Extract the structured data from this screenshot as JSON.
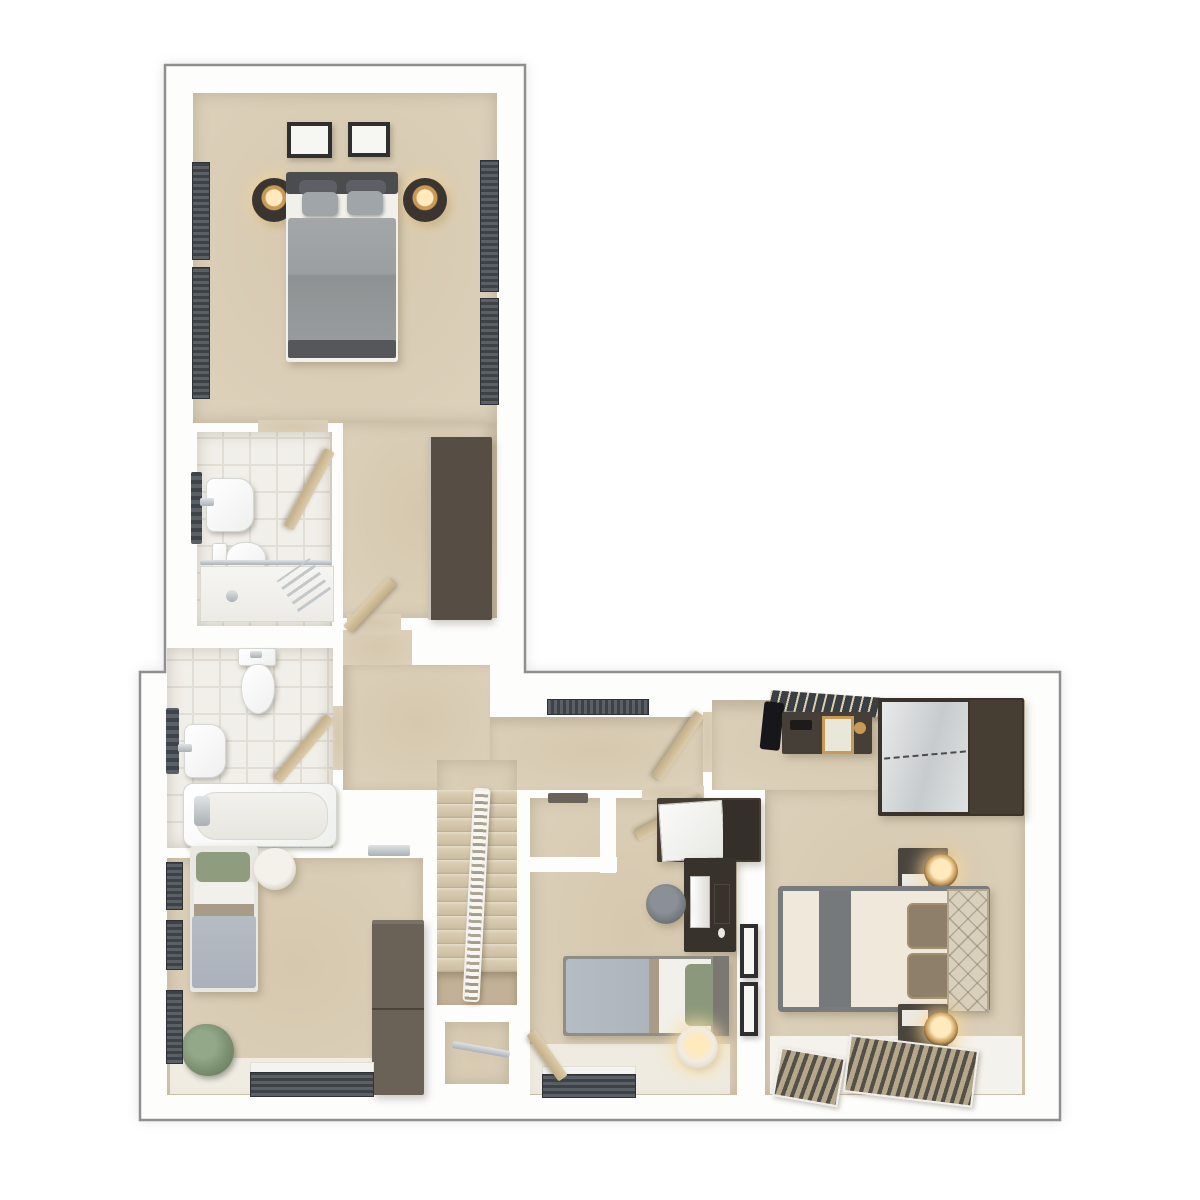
{
  "palette": {
    "wall": "#fdfdfc",
    "outline": "#8f8f8f",
    "carpet_deep": "#d6c8ae",
    "carpet_mid": "#ddd1bb",
    "carpet_light": "#ece5d6",
    "tile": "#f1efe9",
    "grout": "#e1ded5",
    "wood_dark": "#453d34",
    "wood_mid": "#6a6257",
    "wood_desk": "#37322c",
    "door_wood": "#cdb98f",
    "window_dark": "#3d4246",
    "slat_light": "#5a6066",
    "glass": "#c6cacc",
    "duvet_gray": "#9da1a2",
    "duvet_blue": "#b5bcc4",
    "sheet": "#f1f0ea",
    "pillow_green": "#909c7e",
    "taupe": "#a89c89",
    "cream": "#efe8db",
    "runner": "#75797c",
    "headboard_beige": "#d8cfbc",
    "gold": "#c89a55",
    "glow": "#ffe9bd",
    "plant": "#7d9373",
    "stool_gray": "#70757a",
    "mirror_hi": "#e8eaea",
    "mirror_lo": "#c7cbcd"
  },
  "scene": {
    "type": "3d-floor-plan-top-down-render",
    "rooms": [
      {
        "name": "bedroom-1",
        "furniture": [
          "double-bed",
          "headboard",
          "pillows",
          "bedside-table-left",
          "bedside-table-right",
          "table-lamps",
          "wall-art-frames",
          "wardrobe",
          "side-windows"
        ]
      },
      {
        "name": "en-suite",
        "furniture": [
          "basin",
          "toilet",
          "shower-enclosure",
          "towel-radiator",
          "door"
        ]
      },
      {
        "name": "bathroom",
        "furniture": [
          "bath",
          "basin",
          "toilet",
          "towel-radiator",
          "door"
        ]
      },
      {
        "name": "bedroom-2",
        "furniture": [
          "single-bed",
          "round-side-table",
          "plant",
          "wardrobe",
          "windows",
          "door-threshold"
        ]
      },
      {
        "name": "landing",
        "furniture": [
          "staircase",
          "banister",
          "landing-window",
          "under-stairs-cupboard"
        ]
      },
      {
        "name": "bedroom-3",
        "furniture": [
          "single-bed",
          "desk",
          "monitor",
          "desk-stool",
          "cabinet",
          "round-side-table",
          "wall-art-frames",
          "window",
          "built-in-cupboard",
          "door"
        ]
      },
      {
        "name": "bedroom-4",
        "furniture": [
          "double-bed",
          "quilted-headboard",
          "pillows",
          "bedside-table-top",
          "bedside-table-bottom",
          "gold-lamps",
          "dressing-table",
          "mirror",
          "bench",
          "sliding-mirror-wardrobe",
          "hanging-rail",
          "window-blinds"
        ]
      }
    ]
  }
}
